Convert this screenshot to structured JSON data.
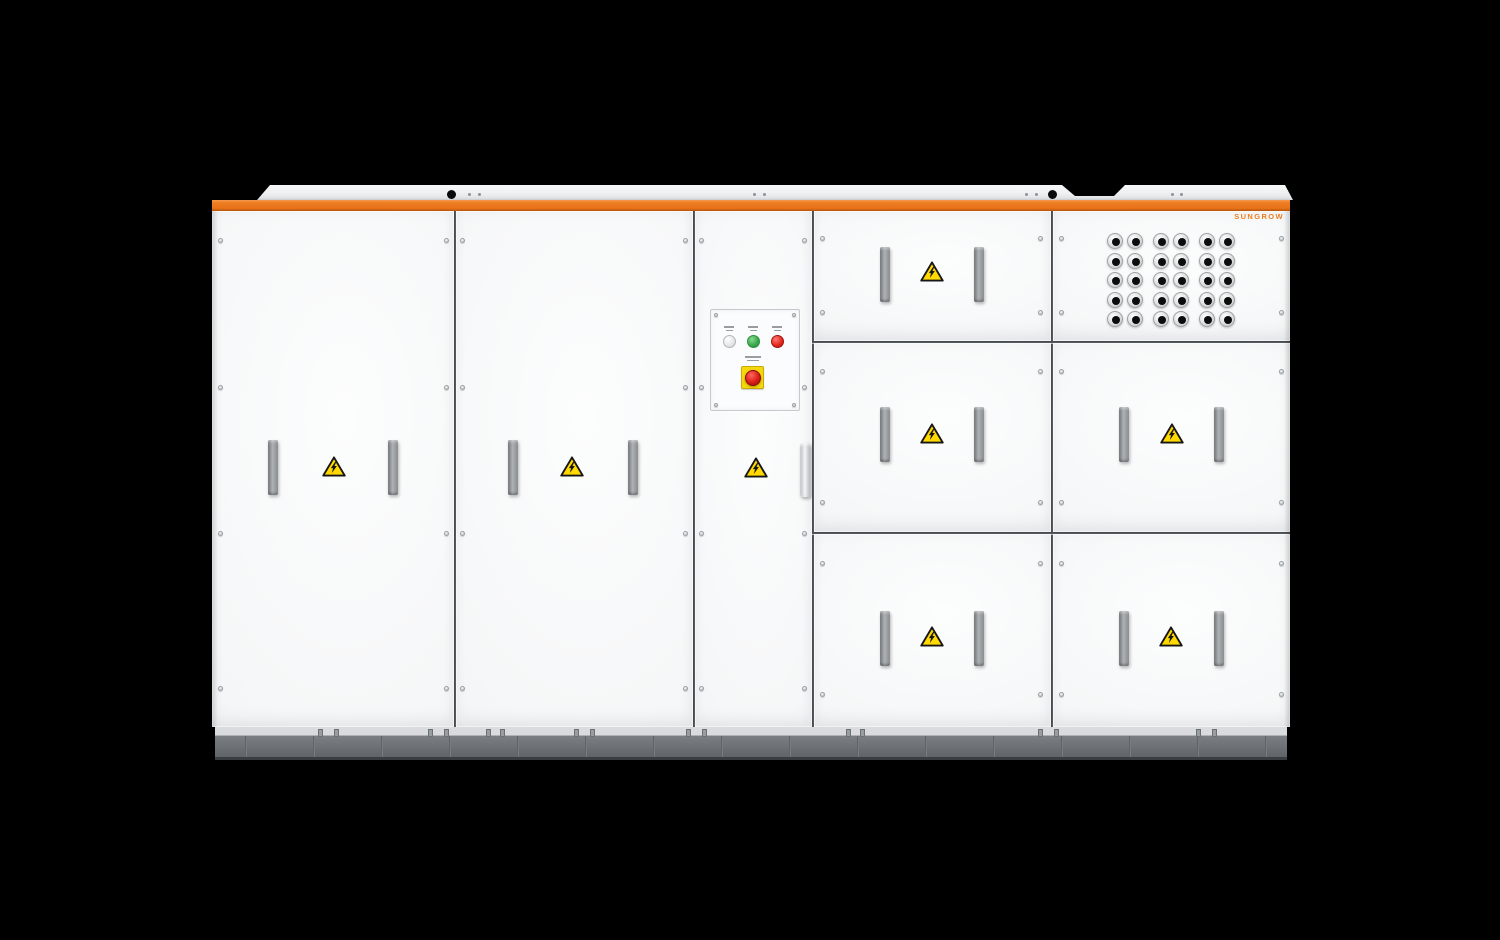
{
  "scene": {
    "type": "product-render",
    "background_color": "#000000",
    "subject": "utility-scale energy storage system cabinet"
  },
  "brand": {
    "logo_text": "SUNGROW",
    "logo_color": "#ED7D21"
  },
  "cabinet": {
    "accent_stripe_color": "#ED7D21",
    "body_color": "#F7F8F9",
    "plinth_color": "#6B6F73",
    "handle_color": "#9A9EA1",
    "door_panels": [
      {
        "name": "left-door-1",
        "features": [
          "handle",
          "handle",
          "high-voltage-warning"
        ]
      },
      {
        "name": "left-door-2",
        "features": [
          "handle",
          "handle",
          "high-voltage-warning"
        ]
      },
      {
        "name": "control-door",
        "features": [
          "control-panel",
          "high-voltage-warning",
          "latch-handle"
        ]
      },
      {
        "name": "right-top-left-door",
        "features": [
          "handle",
          "handle",
          "high-voltage-warning"
        ]
      },
      {
        "name": "right-top-gland-panel",
        "features": [
          "cable-gland-grid",
          "brand-logo"
        ]
      },
      {
        "name": "right-middle-left-door",
        "features": [
          "handle",
          "handle",
          "high-voltage-warning"
        ]
      },
      {
        "name": "right-middle-right-door",
        "features": [
          "handle",
          "handle",
          "high-voltage-warning"
        ]
      },
      {
        "name": "right-bottom-left-door",
        "features": [
          "handle",
          "handle",
          "high-voltage-warning"
        ]
      },
      {
        "name": "right-bottom-right-door",
        "features": [
          "handle",
          "handle",
          "high-voltage-warning"
        ]
      }
    ]
  },
  "warning_sign": {
    "symbol": "lightning-bolt",
    "fill_color": "#FFD900",
    "border_color": "#161616",
    "count": 7
  },
  "control_panel": {
    "indicator_lights": [
      {
        "name": "indicator-white",
        "lens_color": "#EDEFF0"
      },
      {
        "name": "indicator-green",
        "lens_color": "#3AA64A"
      },
      {
        "name": "indicator-red",
        "lens_color": "#E1261C"
      }
    ],
    "emergency_stop": {
      "plate_color": "#F5D800",
      "button_color": "#D6221C"
    },
    "labels_legible": false
  },
  "cable_glands": {
    "rows": 5,
    "column_groups": 3,
    "columns_per_group": 2,
    "total": 30
  }
}
